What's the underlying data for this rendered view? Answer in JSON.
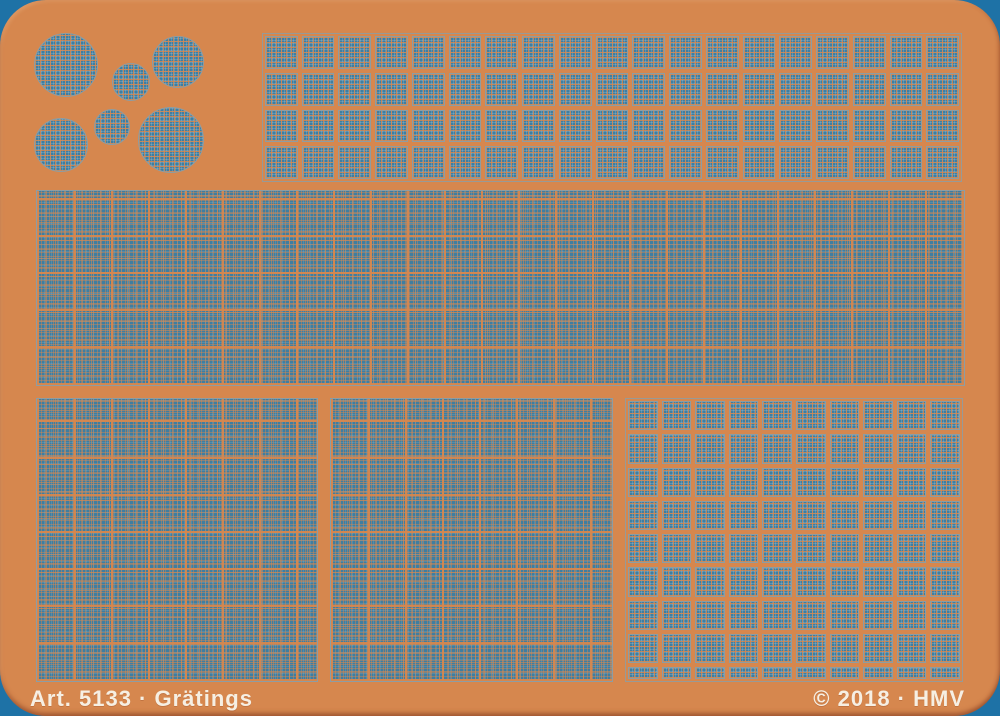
{
  "footer": {
    "article_label": "Art. 5133 · Grätings",
    "copyright_label": "© 2018 · HMV"
  },
  "colors": {
    "background_blue": "#1e72a6",
    "sheet_orange": "#d6874e",
    "mesh_blue": "#3f7ea1",
    "mesh_line_orange": "#d88750",
    "etch_outline_grey": "#8d9da3",
    "footer_text": "#f6efe3"
  },
  "pieces": {
    "circles": [
      {
        "cx": 66,
        "cy": 65,
        "r": 32
      },
      {
        "cx": 178,
        "cy": 62,
        "r": 26
      },
      {
        "cx": 131,
        "cy": 82,
        "r": 19
      },
      {
        "cx": 112,
        "cy": 127,
        "r": 18
      },
      {
        "cx": 61,
        "cy": 145,
        "r": 27
      },
      {
        "cx": 171,
        "cy": 140,
        "r": 33
      }
    ],
    "top_strip": {
      "x": 262,
      "y": 33,
      "w": 700,
      "h": 149,
      "cols": 19,
      "rows": 4,
      "short_last_row_px": 0
    },
    "middle_panel": {
      "x": 36,
      "y": 190,
      "w": 929,
      "h": 196
    },
    "bottom_left_panel": {
      "x": 36,
      "y": 398,
      "w": 282,
      "h": 284
    },
    "bottom_middle_panel": {
      "x": 330,
      "y": 398,
      "w": 283,
      "h": 284
    },
    "bottom_right_grid": {
      "x": 625,
      "y": 398,
      "w": 338,
      "h": 284,
      "cols": 10,
      "rows": 8,
      "short_last_row_px": 12
    }
  },
  "footer_layout": {
    "left_x": 30,
    "right_inset": 35,
    "text_y": 686
  }
}
